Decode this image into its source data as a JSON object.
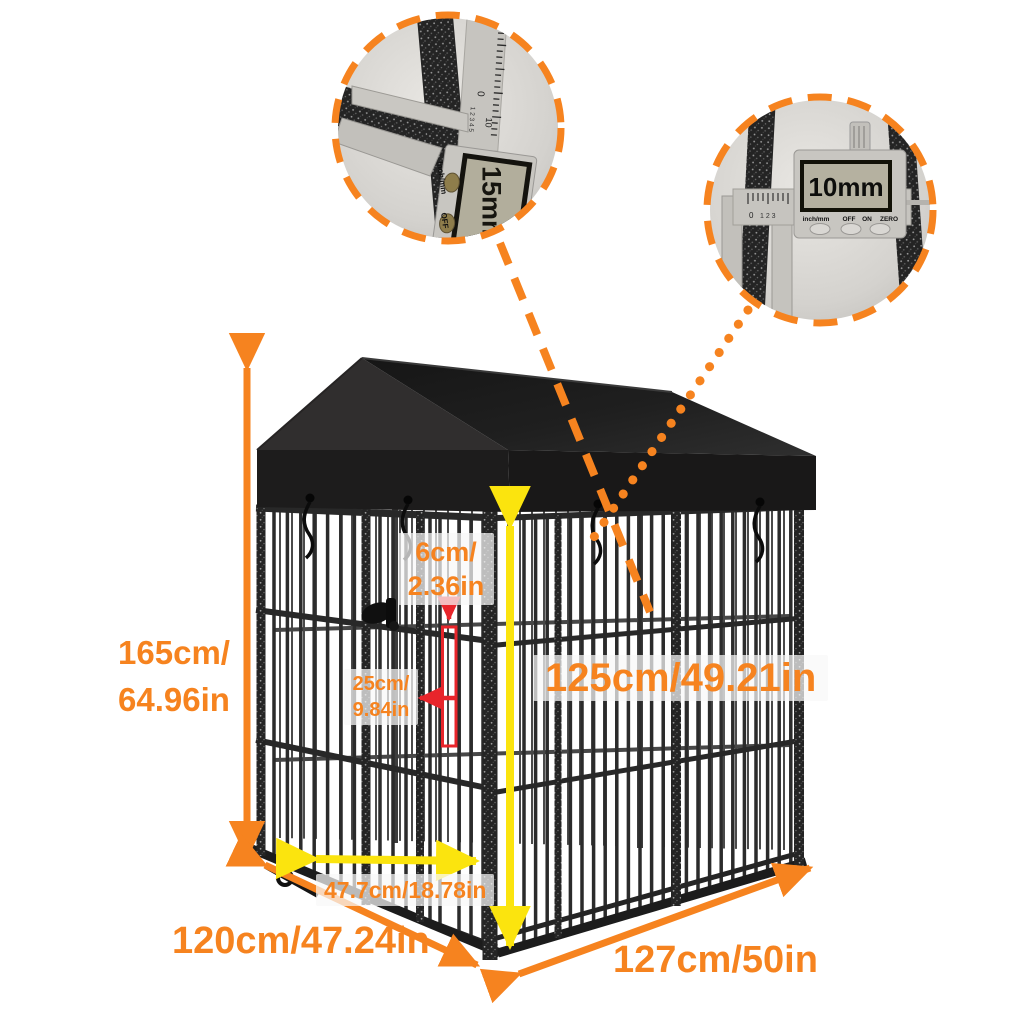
{
  "image": {
    "subject": "dog kennel with roof - dimension diagram"
  },
  "dimension_labels": {
    "overall_height": {
      "line1": "165cm/",
      "line2": "64.96in"
    },
    "bar_gap": {
      "line1": "6cm/",
      "line2": "2.36in"
    },
    "panel_spacing": {
      "line1": "25cm/",
      "line2": "9.84in"
    },
    "inner_height": "125cm/49.21in",
    "gate_width": "47.7cm/18.78in",
    "side_depth": "120cm/47.24in",
    "front_width": "127cm/50in"
  },
  "inset_gauges": [
    {
      "reading": "15mm",
      "scale_zero": "0",
      "scale_vernier": "1 2 3 4 5",
      "scale_ten": "10",
      "button_labels": {
        "mode": "Inch/mm",
        "off": "OFF",
        "on": "ON"
      }
    },
    {
      "reading": "10mm",
      "scale_zero": "0",
      "scale_vernier": "1 2 3",
      "button_labels": {
        "mode": "inch/mm",
        "off": "OFF",
        "on": "ON",
        "zero": "ZERO"
      }
    }
  ],
  "colors": {
    "accent_orange": "#F6831F",
    "accent_yellow": "#FBE40E",
    "accent_red": "#E8252B",
    "roof_dark": "#141414",
    "frame_dark": "#262626"
  }
}
